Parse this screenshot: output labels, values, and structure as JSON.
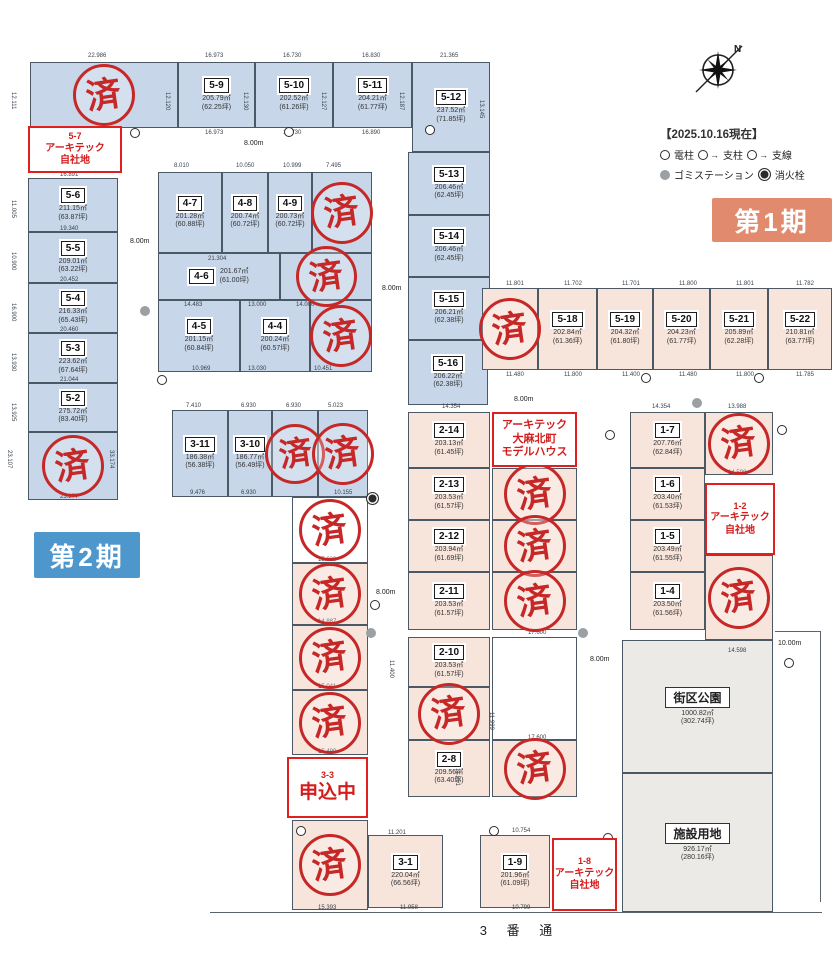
{
  "header": {
    "date_note": "【2025.10.16現在】",
    "phase1_label": "第1期",
    "phase2_label": "第2期",
    "street_label": "3 番 通",
    "compass_n": "N"
  },
  "legend": {
    "items": [
      {
        "sym": "pole",
        "label": "電柱"
      },
      {
        "sym": "support",
        "label": "支柱"
      },
      {
        "sym": "guy",
        "label": "支線"
      },
      {
        "sym": "gomi",
        "label": "ゴミステーション"
      },
      {
        "sym": "hydrant",
        "label": "消火栓"
      }
    ]
  },
  "stamp_text": "済",
  "colors": {
    "phase1_bg": "#e28a6d",
    "phase2_bg": "#4e97cd",
    "blue_lot": "#c7d6e8",
    "pink_lot": "#f7e4da",
    "stamp_red": "#c62727",
    "special_red": "#e01f1f"
  },
  "lots": [
    {
      "sold": true,
      "x": 30,
      "y": 62,
      "w": 148,
      "h": 66,
      "fill": "blue"
    },
    {
      "id": "5-9",
      "area": "205.79㎡",
      "tsubo": "(62.25坪)",
      "x": 178,
      "y": 62,
      "w": 77,
      "h": 66,
      "fill": "blue"
    },
    {
      "id": "5-10",
      "area": "202.52㎡",
      "tsubo": "(61.26坪)",
      "x": 255,
      "y": 62,
      "w": 78,
      "h": 66,
      "fill": "blue"
    },
    {
      "id": "5-11",
      "area": "204.21㎡",
      "tsubo": "(61.77坪)",
      "x": 333,
      "y": 62,
      "w": 79,
      "h": 66,
      "fill": "blue"
    },
    {
      "id": "5-12",
      "area": "237.52㎡",
      "tsubo": "(71.85坪)",
      "x": 412,
      "y": 62,
      "w": 78,
      "h": 90,
      "fill": "blue"
    },
    {
      "id": "5-13",
      "area": "206.46㎡",
      "tsubo": "(62.45坪)",
      "x": 408,
      "y": 152,
      "w": 82,
      "h": 63,
      "fill": "blue"
    },
    {
      "id": "5-14",
      "area": "206.46㎡",
      "tsubo": "(62.45坪)",
      "x": 408,
      "y": 215,
      "w": 82,
      "h": 62,
      "fill": "blue"
    },
    {
      "id": "5-15",
      "area": "206.21㎡",
      "tsubo": "(62.38坪)",
      "x": 408,
      "y": 277,
      "w": 82,
      "h": 63,
      "fill": "blue"
    },
    {
      "id": "5-16",
      "area": "206.22㎡",
      "tsubo": "(62.38坪)",
      "x": 408,
      "y": 340,
      "w": 80,
      "h": 65,
      "fill": "blue"
    },
    {
      "id": "5-6",
      "area": "211.15㎡",
      "tsubo": "(63.87坪)",
      "x": 28,
      "y": 178,
      "w": 90,
      "h": 54,
      "fill": "blue"
    },
    {
      "id": "5-5",
      "area": "209.01㎡",
      "tsubo": "(63.22坪)",
      "x": 28,
      "y": 232,
      "w": 90,
      "h": 51,
      "fill": "blue"
    },
    {
      "id": "5-4",
      "area": "216.33㎡",
      "tsubo": "(65.43坪)",
      "x": 28,
      "y": 283,
      "w": 90,
      "h": 50,
      "fill": "blue"
    },
    {
      "id": "5-3",
      "area": "223.62㎡",
      "tsubo": "(67.64坪)",
      "x": 28,
      "y": 333,
      "w": 90,
      "h": 50,
      "fill": "blue"
    },
    {
      "id": "5-2",
      "area": "275.72㎡",
      "tsubo": "(83.40坪)",
      "x": 28,
      "y": 383,
      "w": 90,
      "h": 49,
      "fill": "blue"
    },
    {
      "sold": true,
      "x": 28,
      "y": 432,
      "w": 90,
      "h": 68,
      "fill": "blue"
    },
    {
      "id": "4-7",
      "area": "201.28㎡",
      "tsubo": "(60.88坪)",
      "x": 158,
      "y": 172,
      "w": 64,
      "h": 81,
      "fill": "blue"
    },
    {
      "id": "4-8",
      "area": "200.74㎡",
      "tsubo": "(60.72坪)",
      "x": 222,
      "y": 172,
      "w": 46,
      "h": 81,
      "fill": "blue"
    },
    {
      "id": "4-9",
      "area": "200.73㎡",
      "tsubo": "(60.72坪)",
      "x": 268,
      "y": 172,
      "w": 44,
      "h": 81,
      "fill": "blue"
    },
    {
      "sold": true,
      "x": 312,
      "y": 172,
      "w": 60,
      "h": 81,
      "fill": "blue"
    },
    {
      "id": "4-6",
      "area": "201.67㎡",
      "tsubo": "(61.00坪)",
      "x": 158,
      "y": 253,
      "w": 122,
      "h": 47,
      "fill": "blue",
      "wide": true
    },
    {
      "sold": true,
      "x": 280,
      "y": 253,
      "w": 92,
      "h": 47,
      "fill": "blue"
    },
    {
      "id": "4-5",
      "area": "201.15㎡",
      "tsubo": "(60.84坪)",
      "x": 158,
      "y": 300,
      "w": 82,
      "h": 72,
      "fill": "blue"
    },
    {
      "id": "4-4",
      "area": "200.24㎡",
      "tsubo": "(60.57坪)",
      "x": 240,
      "y": 300,
      "w": 70,
      "h": 72,
      "fill": "blue"
    },
    {
      "sold": true,
      "x": 310,
      "y": 300,
      "w": 62,
      "h": 72,
      "fill": "blue"
    },
    {
      "id": "3-11",
      "area": "186.38㎡",
      "tsubo": "(56.38坪)",
      "x": 172,
      "y": 410,
      "w": 56,
      "h": 87,
      "fill": "blue"
    },
    {
      "id": "3-10",
      "area": "186.77㎡",
      "tsubo": "(56.49坪)",
      "x": 228,
      "y": 410,
      "w": 44,
      "h": 87,
      "fill": "blue"
    },
    {
      "sold": true,
      "x": 272,
      "y": 410,
      "w": 46,
      "h": 87,
      "fill": "blue"
    },
    {
      "sold": true,
      "x": 318,
      "y": 410,
      "w": 50,
      "h": 87,
      "fill": "blue"
    },
    {
      "sold": true,
      "x": 482,
      "y": 288,
      "w": 56,
      "h": 82,
      "fill": "pink"
    },
    {
      "id": "5-18",
      "area": "202.84㎡",
      "tsubo": "(61.36坪)",
      "x": 538,
      "y": 288,
      "w": 59,
      "h": 82,
      "fill": "pink"
    },
    {
      "id": "5-19",
      "area": "204.32㎡",
      "tsubo": "(61.80坪)",
      "x": 597,
      "y": 288,
      "w": 56,
      "h": 82,
      "fill": "pink"
    },
    {
      "id": "5-20",
      "area": "204.23㎡",
      "tsubo": "(61.77坪)",
      "x": 653,
      "y": 288,
      "w": 57,
      "h": 82,
      "fill": "pink"
    },
    {
      "id": "5-21",
      "area": "205.89㎡",
      "tsubo": "(62.28坪)",
      "x": 710,
      "y": 288,
      "w": 58,
      "h": 82,
      "fill": "pink"
    },
    {
      "id": "5-22",
      "area": "210.81㎡",
      "tsubo": "(63.77坪)",
      "x": 768,
      "y": 288,
      "w": 64,
      "h": 82,
      "fill": "pink"
    },
    {
      "id": "2-14",
      "area": "203.13㎡",
      "tsubo": "(61.45坪)",
      "x": 408,
      "y": 412,
      "w": 82,
      "h": 56,
      "fill": "pink"
    },
    {
      "id": "2-13",
      "area": "203.53㎡",
      "tsubo": "(61.57坪)",
      "x": 408,
      "y": 468,
      "w": 82,
      "h": 52,
      "fill": "pink"
    },
    {
      "sold": true,
      "x": 492,
      "y": 468,
      "w": 85,
      "h": 52,
      "fill": "pink"
    },
    {
      "id": "2-12",
      "area": "203.94㎡",
      "tsubo": "(61.69坪)",
      "x": 408,
      "y": 520,
      "w": 82,
      "h": 52,
      "fill": "pink"
    },
    {
      "sold": true,
      "x": 492,
      "y": 520,
      "w": 85,
      "h": 52,
      "fill": "pink"
    },
    {
      "id": "2-11",
      "area": "203.53㎡",
      "tsubo": "(61.57坪)",
      "x": 408,
      "y": 572,
      "w": 82,
      "h": 58,
      "fill": "pink"
    },
    {
      "sold": true,
      "x": 492,
      "y": 572,
      "w": 85,
      "h": 58,
      "fill": "pink"
    },
    {
      "id": "2-10",
      "area": "203.53㎡",
      "tsubo": "(61.57坪)",
      "x": 408,
      "y": 637,
      "w": 82,
      "h": 50,
      "fill": "pink"
    },
    {
      "x": 492,
      "y": 637,
      "w": 85,
      "h": 103,
      "fill": "white"
    },
    {
      "sold": true,
      "x": 408,
      "y": 687,
      "w": 82,
      "h": 53,
      "fill": "pink"
    },
    {
      "id": "2-8",
      "area": "209.56㎡",
      "tsubo": "(63.40坪)",
      "x": 408,
      "y": 740,
      "w": 82,
      "h": 57,
      "fill": "pink"
    },
    {
      "sold": true,
      "x": 492,
      "y": 740,
      "w": 85,
      "h": 57,
      "fill": "pink"
    },
    {
      "sold": true,
      "x": 292,
      "y": 497,
      "w": 76,
      "h": 66,
      "fill": "white"
    },
    {
      "sold": true,
      "x": 292,
      "y": 563,
      "w": 76,
      "h": 62,
      "fill": "pink"
    },
    {
      "sold": true,
      "x": 292,
      "y": 625,
      "w": 76,
      "h": 65,
      "fill": "pink"
    },
    {
      "sold": true,
      "x": 292,
      "y": 690,
      "w": 76,
      "h": 65,
      "fill": "pink"
    },
    {
      "sold": true,
      "x": 292,
      "y": 820,
      "w": 76,
      "h": 90,
      "fill": "pink"
    },
    {
      "id": "3-1",
      "area": "220.04㎡",
      "tsubo": "(66.56坪)",
      "x": 368,
      "y": 835,
      "w": 75,
      "h": 73,
      "fill": "pink"
    },
    {
      "id": "1-9",
      "area": "201.96㎡",
      "tsubo": "(61.09坪)",
      "x": 480,
      "y": 835,
      "w": 70,
      "h": 73,
      "fill": "pink"
    },
    {
      "id": "1-7",
      "area": "207.76㎡",
      "tsubo": "(62.84坪)",
      "x": 630,
      "y": 412,
      "w": 75,
      "h": 56,
      "fill": "pink"
    },
    {
      "sold": true,
      "x": 705,
      "y": 412,
      "w": 68,
      "h": 63,
      "fill": "pink"
    },
    {
      "id": "1-6",
      "area": "203.40㎡",
      "tsubo": "(61.53坪)",
      "x": 630,
      "y": 468,
      "w": 75,
      "h": 52,
      "fill": "pink"
    },
    {
      "id": "1-5",
      "area": "203.49㎡",
      "tsubo": "(61.55坪)",
      "x": 630,
      "y": 520,
      "w": 75,
      "h": 52,
      "fill": "pink"
    },
    {
      "id": "1-4",
      "area": "203.50㎡",
      "tsubo": "(61.56坪)",
      "x": 630,
      "y": 572,
      "w": 75,
      "h": 58,
      "fill": "pink"
    },
    {
      "sold": true,
      "x": 705,
      "y": 555,
      "w": 68,
      "h": 85,
      "fill": "pink"
    },
    {
      "name": "街区公園",
      "area": "1000.82㎡",
      "tsubo": "(302.74坪)",
      "x": 622,
      "y": 640,
      "w": 151,
      "h": 133,
      "fill": "gray"
    },
    {
      "name": "施設用地",
      "area": "926.17㎡",
      "tsubo": "(280.16坪)",
      "x": 622,
      "y": 773,
      "w": 151,
      "h": 139,
      "fill": "gray"
    }
  ],
  "special_boxes": [
    {
      "name": "label-5-7-own",
      "lines": [
        "5-7",
        "アーキテック",
        "自社地"
      ],
      "sizes": [
        9,
        10,
        10
      ],
      "x": 28,
      "y": 126,
      "w": 94,
      "h": 47
    },
    {
      "name": "label-model-house",
      "lines": [
        "アーキテック",
        "大麻北町",
        "モデルハウス"
      ],
      "sizes": [
        11,
        11,
        11
      ],
      "x": 492,
      "y": 412,
      "w": 85,
      "h": 55
    },
    {
      "name": "label-1-2-own",
      "lines": [
        "1-2",
        "アーキテック",
        "自社地"
      ],
      "sizes": [
        9,
        10,
        10
      ],
      "x": 705,
      "y": 483,
      "w": 70,
      "h": 72
    },
    {
      "name": "label-3-3-pending",
      "lines": [
        "3-3",
        "申込中"
      ],
      "sizes": [
        9,
        19
      ],
      "x": 287,
      "y": 757,
      "w": 81,
      "h": 61
    },
    {
      "name": "label-1-8-own",
      "lines": [
        "1-8",
        "アーキテック",
        "自社地"
      ],
      "sizes": [
        9,
        10,
        10
      ],
      "x": 552,
      "y": 838,
      "w": 65,
      "h": 73
    }
  ],
  "road_labels": [
    [
      "8.00m",
      244,
      140
    ],
    [
      "8.00m",
      130,
      238
    ],
    [
      "8.00m",
      382,
      285
    ],
    [
      "8.00m",
      514,
      396
    ],
    [
      "8.00m",
      376,
      589
    ],
    [
      "8.00m",
      590,
      656
    ],
    [
      "10.00m",
      778,
      640
    ]
  ],
  "dims": [
    [
      "22.986",
      88,
      53
    ],
    [
      "16.973",
      205,
      53
    ],
    [
      "16.730",
      283,
      53
    ],
    [
      "16.830",
      362,
      53
    ],
    [
      "21.365",
      440,
      53
    ],
    [
      "12.111",
      16,
      92,
      90
    ],
    [
      "12.120",
      170,
      92,
      90
    ],
    [
      "12.130",
      248,
      92,
      90
    ],
    [
      "12.127",
      326,
      92,
      90
    ],
    [
      "12.187",
      404,
      92,
      90
    ],
    [
      "13.145",
      484,
      100,
      90
    ],
    [
      "16.973",
      205,
      130
    ],
    [
      "16.730",
      283,
      130
    ],
    [
      "16.890",
      362,
      130
    ],
    [
      "8.010",
      174,
      163
    ],
    [
      "10.050",
      236,
      163
    ],
    [
      "10.999",
      283,
      163
    ],
    [
      "7.495",
      326,
      163
    ],
    [
      "21.304",
      208,
      256
    ],
    [
      "14.483",
      184,
      302
    ],
    [
      "13.000",
      248,
      302
    ],
    [
      "14.000",
      296,
      302
    ],
    [
      "10.969",
      192,
      366
    ],
    [
      "13.030",
      248,
      366
    ],
    [
      "10.451",
      314,
      366
    ],
    [
      "16.891",
      60,
      172
    ],
    [
      "19.340",
      60,
      226
    ],
    [
      "20.452",
      60,
      277
    ],
    [
      "20.460",
      60,
      327
    ],
    [
      "21.044",
      60,
      377
    ],
    [
      "23.377",
      60,
      494
    ],
    [
      "11.005",
      16,
      200,
      90
    ],
    [
      "10.900",
      16,
      252,
      90
    ],
    [
      "16.900",
      16,
      303,
      90
    ],
    [
      "13.930",
      16,
      353,
      90
    ],
    [
      "13.925",
      16,
      403,
      90
    ],
    [
      "23.107",
      12,
      450,
      90
    ],
    [
      "33.174",
      114,
      450,
      90
    ],
    [
      "7.410",
      186,
      403
    ],
    [
      "6.930",
      241,
      403
    ],
    [
      "6.930",
      286,
      403
    ],
    [
      "5.023",
      328,
      403
    ],
    [
      "9.476",
      190,
      490
    ],
    [
      "6.930",
      241,
      490
    ],
    [
      "10.155",
      334,
      490
    ],
    [
      "11.801",
      506,
      281
    ],
    [
      "11.702",
      564,
      281
    ],
    [
      "11.701",
      622,
      281
    ],
    [
      "11.800",
      679,
      281
    ],
    [
      "11.801",
      736,
      281
    ],
    [
      "11.782",
      796,
      281
    ],
    [
      "11.480",
      506,
      372
    ],
    [
      "11.800",
      564,
      372
    ],
    [
      "11.400",
      622,
      372
    ],
    [
      "11.480",
      679,
      372
    ],
    [
      "11.800",
      736,
      372
    ],
    [
      "11.785",
      796,
      372
    ],
    [
      "14.354",
      442,
      404
    ],
    [
      "14.354",
      652,
      404
    ],
    [
      "13.988",
      728,
      404
    ],
    [
      "14.598",
      728,
      470
    ],
    [
      "14.598",
      728,
      648
    ],
    [
      "15.039",
      318,
      557
    ],
    [
      "14.887",
      318,
      619
    ],
    [
      "15.041",
      318,
      684
    ],
    [
      "15.490",
      318,
      749
    ],
    [
      "15.393",
      318,
      905
    ],
    [
      "10.754",
      512,
      828
    ],
    [
      "11.201",
      388,
      830
    ],
    [
      "11.958",
      400,
      905
    ],
    [
      "10.799",
      512,
      905
    ],
    [
      "17.600",
      528,
      630
    ],
    [
      "17.600",
      528,
      735
    ],
    [
      "11.400",
      394,
      660,
      90
    ],
    [
      "11.999",
      494,
      712,
      90
    ],
    [
      "11.251",
      460,
      768,
      90
    ]
  ],
  "symbols": [
    {
      "t": "pole",
      "x": 130,
      "y": 128
    },
    {
      "t": "pole",
      "x": 284,
      "y": 127
    },
    {
      "t": "pole",
      "x": 425,
      "y": 125
    },
    {
      "t": "pole",
      "x": 157,
      "y": 375
    },
    {
      "t": "pole",
      "x": 605,
      "y": 430
    },
    {
      "t": "pole",
      "x": 370,
      "y": 600
    },
    {
      "t": "pole",
      "x": 296,
      "y": 826
    },
    {
      "t": "pole",
      "x": 489,
      "y": 826
    },
    {
      "t": "pole",
      "x": 784,
      "y": 658
    },
    {
      "t": "pole",
      "x": 777,
      "y": 425
    },
    {
      "t": "pole",
      "x": 603,
      "y": 833
    },
    {
      "t": "pole",
      "x": 641,
      "y": 373
    },
    {
      "t": "pole",
      "x": 754,
      "y": 373
    },
    {
      "t": "gomi",
      "x": 140,
      "y": 306
    },
    {
      "t": "gomi",
      "x": 366,
      "y": 628
    },
    {
      "t": "gomi",
      "x": 578,
      "y": 628
    },
    {
      "t": "gomi",
      "x": 692,
      "y": 398
    },
    {
      "t": "hydrant",
      "x": 366,
      "y": 492
    }
  ]
}
